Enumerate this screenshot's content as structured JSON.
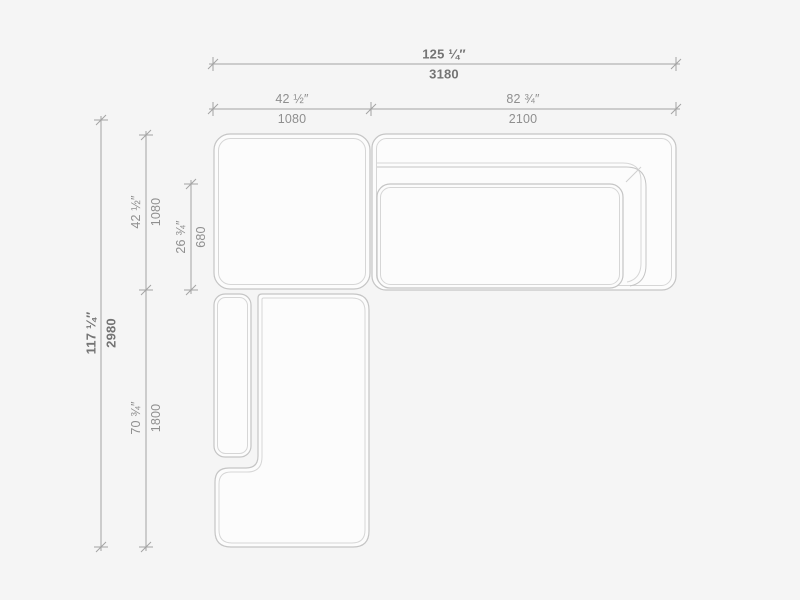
{
  "page": {
    "background_color": "#f5f5f5",
    "content": "sectional-sofa-technical-drawing-top-view"
  },
  "drawing": {
    "colors": {
      "outline": "#c5c5c5",
      "seam": "#d6d6d6",
      "fill": "#fcfcfc",
      "dim_line": "#a3a3a3",
      "dim_text": "#8f8f8f",
      "dim_text_bold": "#747474"
    },
    "pieces": [
      "corner-ottoman-module",
      "right-sofa-module-with-backrest-and-arm",
      "right-sofa-seat-cushion",
      "bottom-chaise-armrest",
      "bottom-chaise-module"
    ]
  },
  "dimensions": {
    "overall_width": {
      "inches": "125 ¼″",
      "mm": "3180"
    },
    "left_module_width": {
      "inches": "42 ½″",
      "mm": "1080"
    },
    "right_module_width": {
      "inches": "82 ¾″",
      "mm": "2100"
    },
    "overall_depth": {
      "inches": "117 ¼″",
      "mm": "2980"
    },
    "left_module_depth": {
      "inches": "42 ½″",
      "mm": "1080"
    },
    "seat_depth": {
      "inches": "26 ¾″",
      "mm": "680"
    },
    "chaise_length": {
      "inches": "70 ¾″",
      "mm": "1800"
    }
  }
}
